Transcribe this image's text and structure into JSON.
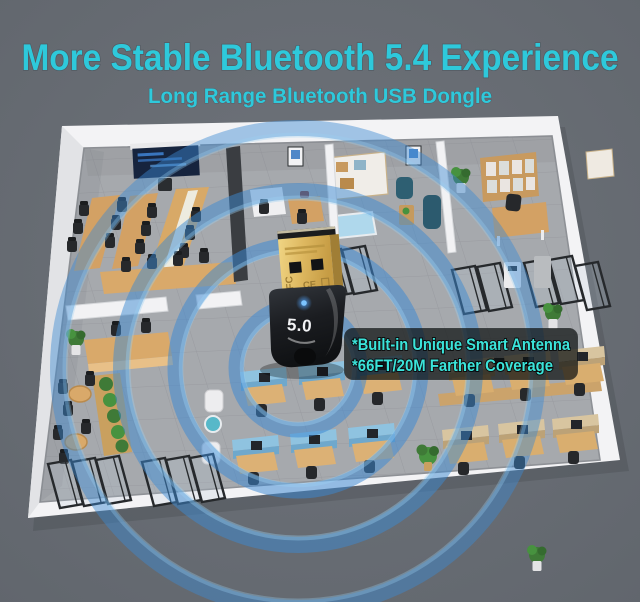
{
  "header": {
    "title": "More Stable Bluetooth 5.4 Experience",
    "subtitle": "Long Range Bluetooth USB Dongle"
  },
  "callout": {
    "line1": "*Built-in Unique Smart Antenna",
    "line2": "*66FT/20M Farther Coverage"
  },
  "dongle": {
    "version_label": "5.0",
    "fcc_mark": "FC",
    "ce_mark": "CE"
  },
  "colors": {
    "background": "#676C73",
    "title_cyan": "#2EC9DB",
    "callout_cyan": "#3BE4DA",
    "callout_bg": "rgba(12,16,16,0.72)",
    "signal_blue": "#3C89D2",
    "signal_light_blue": "#9CCFF2",
    "usb_gold": "#D9B35C",
    "dongle_black": "#1B1D20",
    "led_blue": "#5FB4FF",
    "floor_gray": "#A6A9AD",
    "wall_white": "#F3F3F5",
    "wood": "#D3A164",
    "partition_blue": "#8FC3E0",
    "partition_tan": "#D8C5A0",
    "plant_green": "#3F7A37"
  }
}
